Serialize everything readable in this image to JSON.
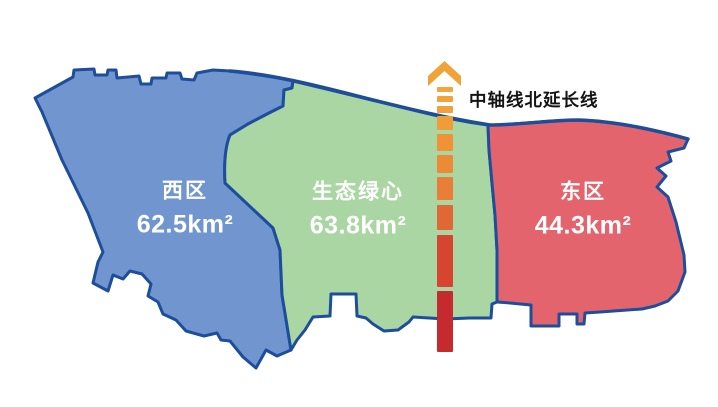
{
  "figure": {
    "background": "#FFFFFF"
  },
  "colors": {
    "outline": "#1E4E9B",
    "region_label_text": "#FFFFFF",
    "axis_label_text": "#141414"
  },
  "regions": {
    "west": {
      "name": "西区",
      "area": "62.5km²",
      "color": "#7195CF"
    },
    "center": {
      "name": "生态绿心",
      "area": "63.8km²",
      "color": "#A9D6A2"
    },
    "east": {
      "name": "东区",
      "area": "44.3km²",
      "color": "#E4646E"
    }
  },
  "axis": {
    "label": "中轴线北延长线",
    "arrow_color": "#F0A336",
    "x": 437,
    "width": 16,
    "dashes": [
      {
        "y": 87,
        "h": 5,
        "color": "#F2A63C"
      },
      {
        "y": 96,
        "h": 6,
        "color": "#F2A43A"
      },
      {
        "y": 106,
        "h": 7,
        "color": "#F1A139"
      },
      {
        "y": 116,
        "h": 14,
        "color": "#F09C37"
      },
      {
        "y": 134,
        "h": 17,
        "color": "#EF9336"
      },
      {
        "y": 155,
        "h": 18,
        "color": "#EC8A36"
      },
      {
        "y": 177,
        "h": 23,
        "color": "#E87E38"
      },
      {
        "y": 205,
        "h": 25,
        "color": "#E16834"
      },
      {
        "y": 235,
        "h": 52,
        "color": "#D74430"
      },
      {
        "y": 291,
        "h": 61,
        "color": "#C52A2F"
      }
    ]
  }
}
